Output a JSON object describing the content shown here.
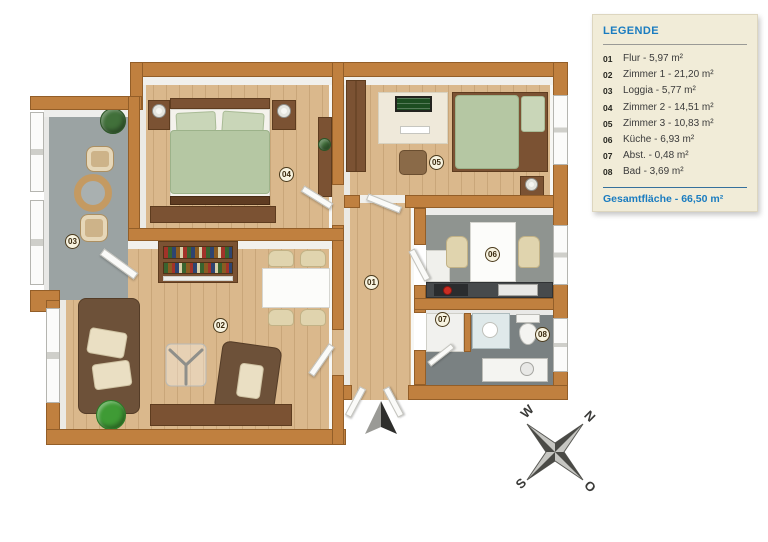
{
  "legend": {
    "title": "LEGENDE",
    "items": [
      {
        "num": "01",
        "text": "Flur - 5,97 m²"
      },
      {
        "num": "02",
        "text": "Zimmer 1 - 21,20 m²"
      },
      {
        "num": "03",
        "text": "Loggia - 5,77 m²"
      },
      {
        "num": "04",
        "text": "Zimmer 2 - 14,51 m²"
      },
      {
        "num": "05",
        "text": "Zimmer 3 - 10,83 m²"
      },
      {
        "num": "06",
        "text": "Küche - 6,93 m²"
      },
      {
        "num": "07",
        "text": "Abst. - 0,48 m²"
      },
      {
        "num": "08",
        "text": "Bad - 3,69 m²"
      }
    ],
    "total": "Gesamtfläche - 66,50 m²"
  },
  "plan": {
    "badges": [
      {
        "num": "01"
      },
      {
        "num": "02"
      },
      {
        "num": "03"
      },
      {
        "num": "04"
      },
      {
        "num": "05"
      },
      {
        "num": "06"
      },
      {
        "num": "07"
      },
      {
        "num": "08"
      }
    ]
  },
  "compass": {
    "north": "N",
    "east": "O",
    "south": "S",
    "west": "W"
  },
  "colors": {
    "wall": "#c0803f",
    "wood_floor": "#dab88c",
    "loggia_floor": "#9ba3a3",
    "bath_floor": "#7a8182",
    "duvet_green": "#b5c7a3",
    "legend_accent": "#1a7cc0",
    "legend_background": "#f1ecd8"
  }
}
